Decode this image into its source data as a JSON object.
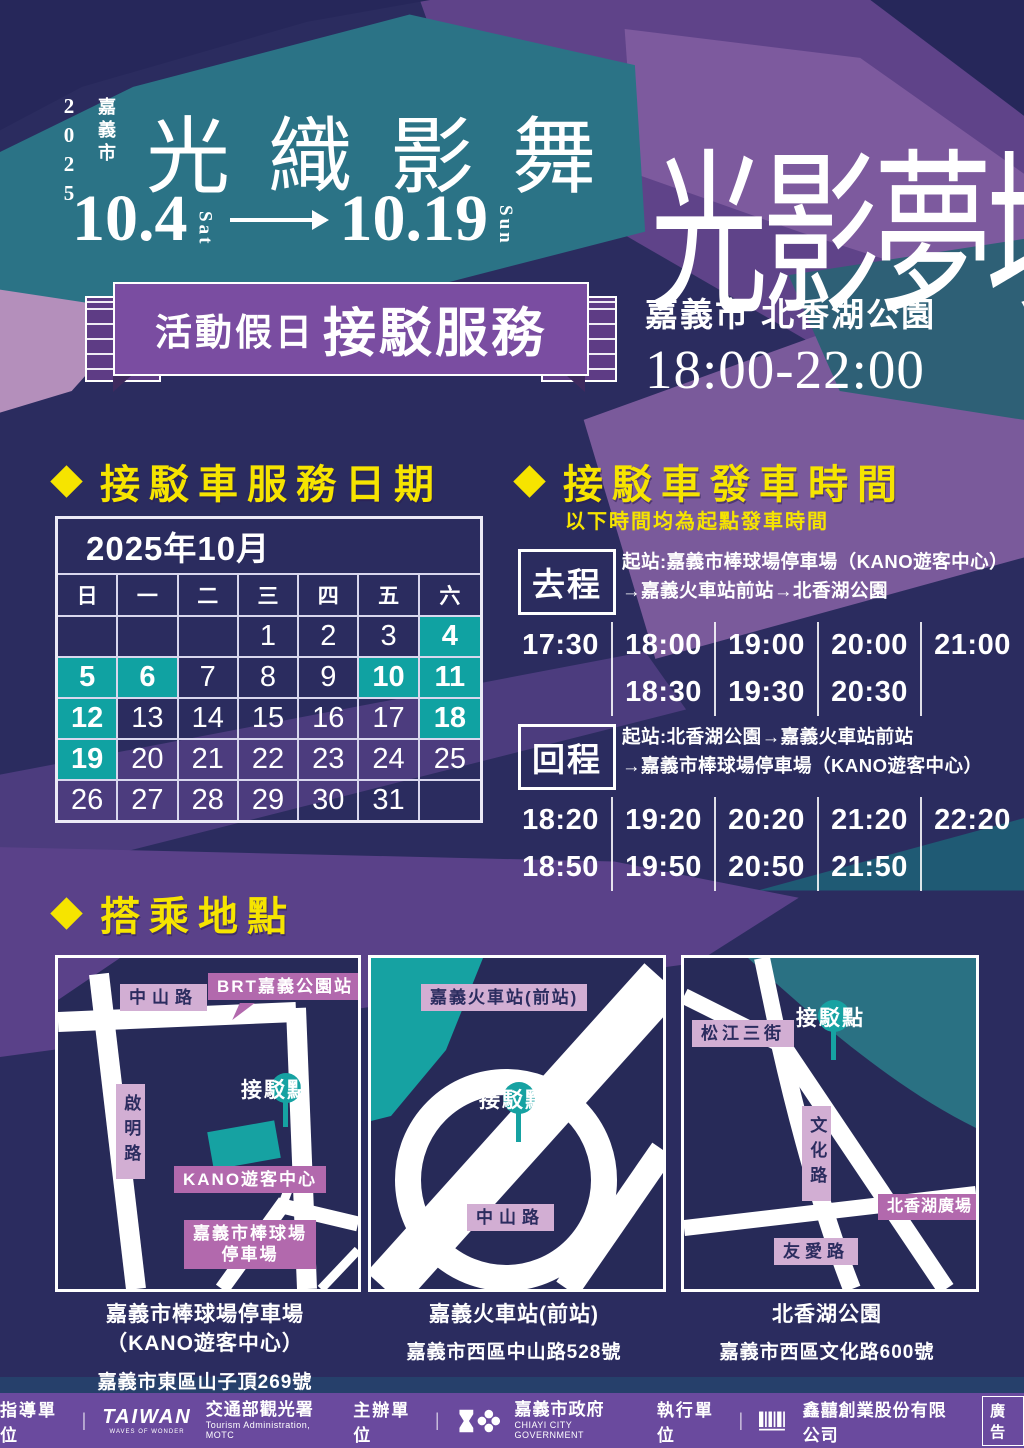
{
  "colors": {
    "accent_yellow": "#f6e400",
    "highlight_teal": "#10a2a2",
    "banner_purple": "#7a4da1",
    "footer_purple": "#6a4a9e",
    "label_light_pink": "#d2aed3",
    "label_dark_pink": "#b269ad"
  },
  "header": {
    "year": "2025",
    "city": "嘉義市",
    "logo": "光織影舞",
    "main_title": "光影夢境",
    "date_start": "10.4",
    "date_start_day": "Sat",
    "date_end": "10.19",
    "date_end_day": "Sun"
  },
  "banner": {
    "prefix": "活動假日",
    "title": "接駁服務"
  },
  "event": {
    "location": "嘉義市 北香湖公園",
    "hours": "18:00-22:00"
  },
  "calendar": {
    "heading": "接駁車服務日期",
    "month_title": "2025年10月",
    "weekdays": [
      "日",
      "一",
      "二",
      "三",
      "四",
      "五",
      "六"
    ],
    "weeks": [
      [
        {
          "d": "",
          "hl": false
        },
        {
          "d": "",
          "hl": false
        },
        {
          "d": "",
          "hl": false
        },
        {
          "d": "1",
          "hl": false
        },
        {
          "d": "2",
          "hl": false
        },
        {
          "d": "3",
          "hl": false
        },
        {
          "d": "4",
          "hl": true
        }
      ],
      [
        {
          "d": "5",
          "hl": true
        },
        {
          "d": "6",
          "hl": true
        },
        {
          "d": "7",
          "hl": false
        },
        {
          "d": "8",
          "hl": false
        },
        {
          "d": "9",
          "hl": false
        },
        {
          "d": "10",
          "hl": true
        },
        {
          "d": "11",
          "hl": true
        }
      ],
      [
        {
          "d": "12",
          "hl": true
        },
        {
          "d": "13",
          "hl": false
        },
        {
          "d": "14",
          "hl": false
        },
        {
          "d": "15",
          "hl": false
        },
        {
          "d": "16",
          "hl": false
        },
        {
          "d": "17",
          "hl": false
        },
        {
          "d": "18",
          "hl": true
        }
      ],
      [
        {
          "d": "19",
          "hl": true
        },
        {
          "d": "20",
          "hl": false
        },
        {
          "d": "21",
          "hl": false
        },
        {
          "d": "22",
          "hl": false
        },
        {
          "d": "23",
          "hl": false
        },
        {
          "d": "24",
          "hl": false
        },
        {
          "d": "25",
          "hl": false
        }
      ],
      [
        {
          "d": "26",
          "hl": false
        },
        {
          "d": "27",
          "hl": false
        },
        {
          "d": "28",
          "hl": false
        },
        {
          "d": "29",
          "hl": false
        },
        {
          "d": "30",
          "hl": false
        },
        {
          "d": "31",
          "hl": false
        },
        {
          "d": "",
          "hl": false
        }
      ]
    ]
  },
  "schedule": {
    "heading": "接駁車發車時間",
    "note": "以下時間均為起點發車時間",
    "outbound": {
      "label": "去程",
      "desc1": "起站:嘉義市棒球場停車場（KANO遊客中心）",
      "desc2": "→嘉義火車站前站→北香湖公園",
      "columns": [
        [
          "17:30",
          ""
        ],
        [
          "18:00",
          "18:30"
        ],
        [
          "19:00",
          "19:30"
        ],
        [
          "20:00",
          "20:30"
        ],
        [
          "21:00",
          ""
        ]
      ]
    },
    "inbound": {
      "label": "回程",
      "desc1": "起站:北香湖公園→嘉義火車站前站",
      "desc2": "→嘉義市棒球場停車場（KANO遊客中心）",
      "columns": [
        [
          "18:20",
          "18:50"
        ],
        [
          "19:20",
          "19:50"
        ],
        [
          "20:20",
          "20:50"
        ],
        [
          "21:20",
          "21:50"
        ],
        [
          "22:20",
          ""
        ]
      ]
    }
  },
  "maps": {
    "heading": "搭乘地點",
    "map1": {
      "road_top": "中山路",
      "brt": "BRT嘉義公園站",
      "pickup": "接駁點",
      "road_left": "啟明路",
      "kano": "KANO遊客中心",
      "parking1": "嘉義市棒球場",
      "parking2": "停車場",
      "cap1": "嘉義市棒球場停車場",
      "cap2": "（KANO遊客中心）",
      "addr": "嘉義市東區山子頂269號"
    },
    "map2": {
      "station": "嘉義火車站(前站)",
      "pickup": "接駁點",
      "road": "中山路",
      "cap1": "嘉義火車站(前站)",
      "addr": "嘉義市西區中山路528號"
    },
    "map3": {
      "road1": "松江三街",
      "pickup": "接駁點",
      "road2": "文化路",
      "plaza": "北香湖廣場",
      "road3": "友愛路",
      "cap1": "北香湖公園",
      "addr": "嘉義市西區文化路600號"
    }
  },
  "footer": {
    "advisor_label": "指導單位",
    "taiwan": "TAIWAN",
    "taiwan_sub": "WAVES OF WONDER",
    "tourism": "交通部觀光署",
    "tourism_en": "Tourism Administration, MOTC",
    "organizer_label": "主辦單位",
    "chiayi": "嘉義市政府",
    "chiayi_en": "CHIAYI CITY GOVERNMENT",
    "executor_label": "執行單位",
    "company": "鑫囍創業股份有限公司",
    "ad": "廣告"
  }
}
